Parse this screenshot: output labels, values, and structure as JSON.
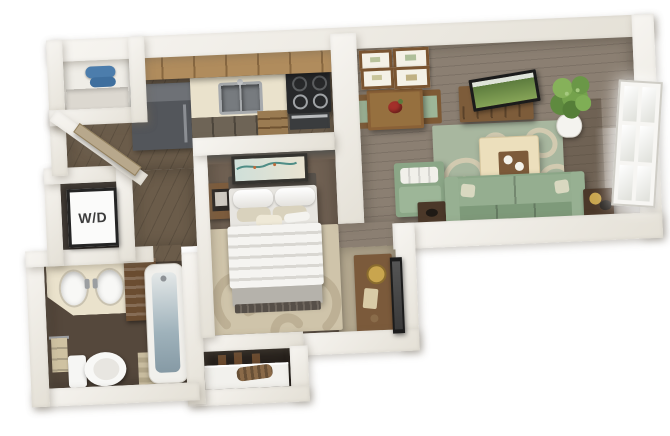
{
  "floorplan": {
    "title": "3D studio apartment floor plan",
    "labels": {
      "washer_dryer": "W/D"
    },
    "colors": {
      "wall_light": "#f7f5f1",
      "wall_shade": "#e4e0d6",
      "floor_wood_dark": "#6b5c4a",
      "floor_wood_living": "#8b7f72",
      "floor_bath": "#55483c",
      "floor_bedroom": "#6f6052",
      "carpet_tan": "#b4a88f",
      "rug_tan": "#cfc4aa",
      "rug_tan_pattern": "#b7aa8e",
      "rug_green": "#a8b79f",
      "rug_green_pattern": "#d6cdb2",
      "sofa_green": "#8ba687",
      "cushion_green": "#9db698",
      "ottoman_cream": "#ecdfbc",
      "wood_cabinet": "#b08c5d",
      "wood_furniture": "#8a6137",
      "wood_dark_furniture": "#4b3829",
      "counter_cream": "#eae2cc",
      "appliance_gray": "#53565b",
      "stove_black": "#27282a",
      "bed_white": "#f5f4f1",
      "bed_stripe": "#d9d7d2",
      "bed_foot_gray": "#b5b2ab",
      "towel_blue": "#4c7dac",
      "plant_green": "#6f9a4a",
      "accent_red": "#a3302a",
      "tub_glass": "#9fb2bb"
    },
    "rooms": [
      {
        "name": "kitchen",
        "furniture": [
          "refrigerator",
          "double-sink",
          "stove-oven",
          "upper-cabinets",
          "counter",
          "drawers"
        ]
      },
      {
        "name": "living-dining",
        "furniture": [
          "dining-table",
          "dining-chairs",
          "four-wall-frames",
          "tv-console",
          "tv",
          "potted-plant",
          "window",
          "green-area-rug",
          "ottoman-with-tray",
          "sofa",
          "chaise",
          "side-tables"
        ]
      },
      {
        "name": "bedroom-area",
        "furniture": [
          "bed",
          "nightstand",
          "wall-art",
          "tan-area-rug",
          "console-table",
          "leaning-mirror"
        ]
      },
      {
        "name": "bathroom",
        "furniture": [
          "double-vanity",
          "toilet",
          "bathtub",
          "linen-shelf",
          "towel",
          "bath-mat"
        ]
      },
      {
        "name": "washer-dryer-closet",
        "furniture": [
          "wd-sign"
        ]
      },
      {
        "name": "entry-closet",
        "furniture": [
          "shelf",
          "blue-towels"
        ]
      },
      {
        "name": "storage-closet",
        "furniture": [
          "dresser",
          "hanging-items"
        ]
      }
    ]
  }
}
